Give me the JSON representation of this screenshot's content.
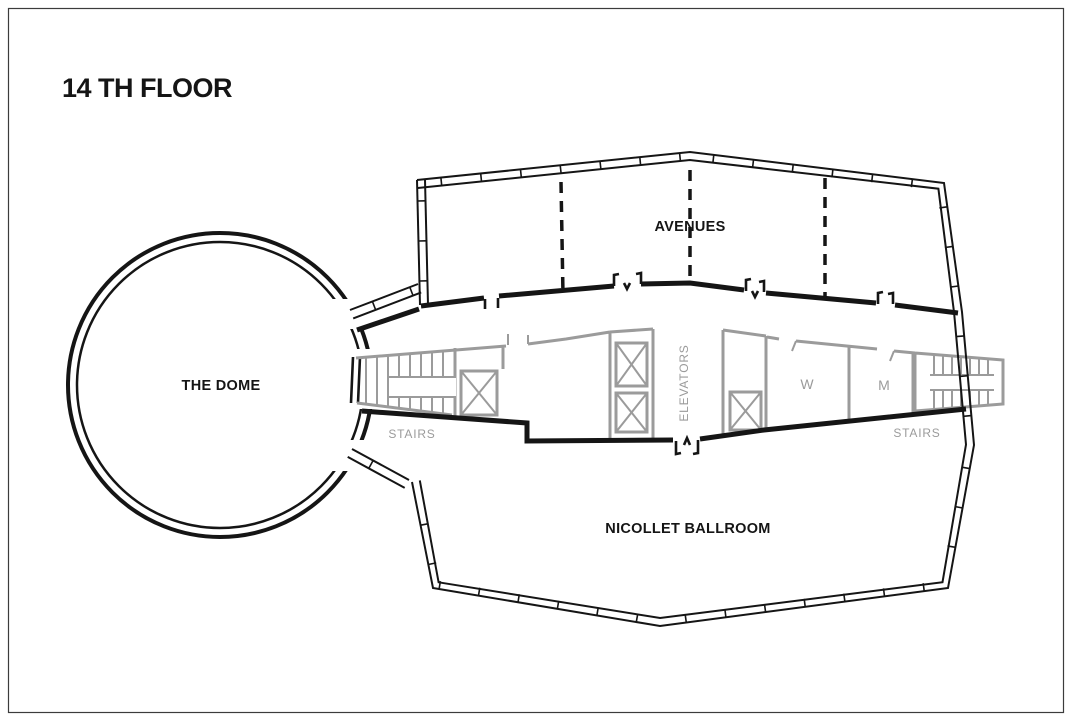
{
  "page": {
    "title": "14 TH FLOOR"
  },
  "colors": {
    "wall_black": "#151515",
    "interior_gray": "#9b9b9b",
    "background": "#ffffff",
    "frame_border": "#3c3c3c"
  },
  "labels": {
    "dome": "THE DOME",
    "avenues": "AVENUES",
    "ballroom": "NICOLLET BALLROOM",
    "elevators": "ELEVATORS",
    "stairs_left": "STAIRS",
    "stairs_right": "STAIRS",
    "women_restroom": "W",
    "men_restroom": "M"
  }
}
